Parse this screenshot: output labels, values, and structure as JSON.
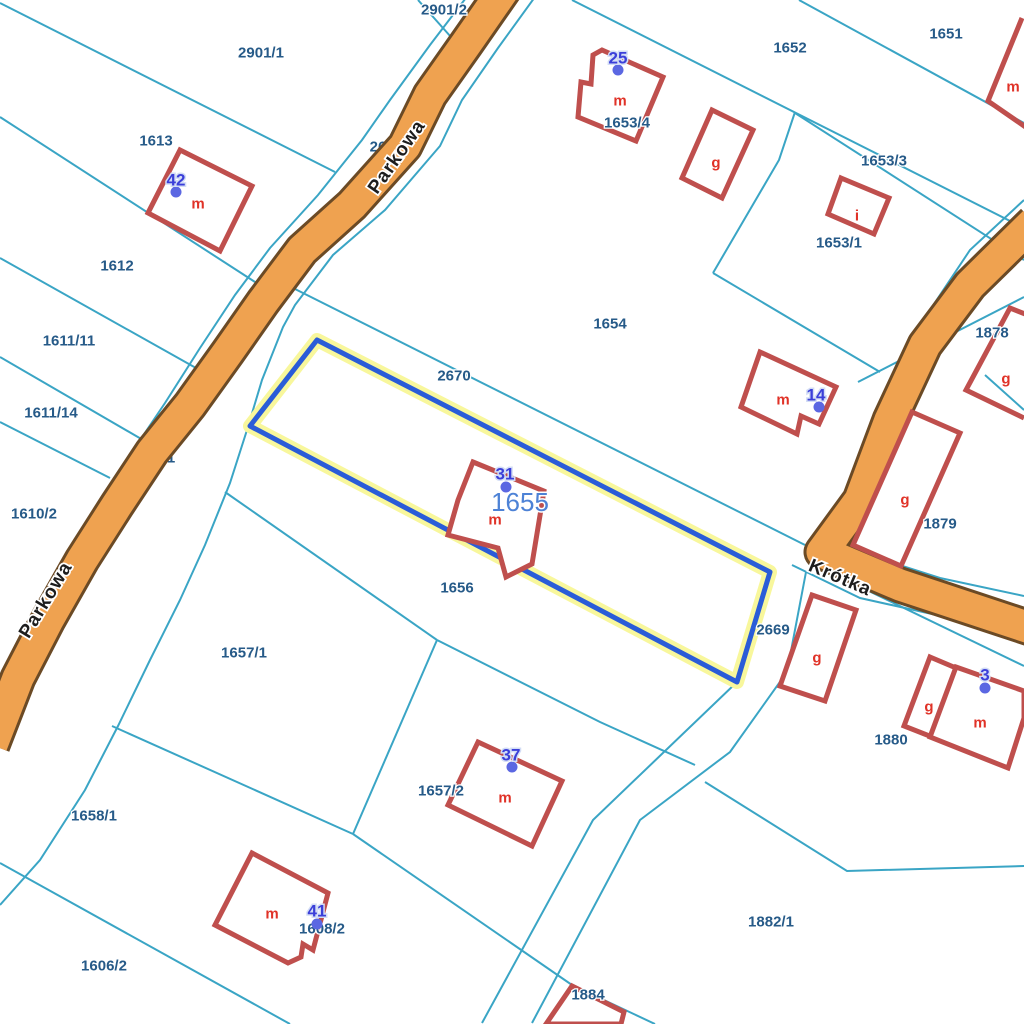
{
  "colors": {
    "background": "#ffffff",
    "parcel_line": "#3aa5c5",
    "building": "#bf4f4d",
    "building_letter": "#e03227",
    "road_fill": "#efa250",
    "road_border": "#6b4a25",
    "highlight_blue": "#2a5cd8",
    "highlight_halo": "#f8f79c",
    "parcel_label": "#265a88",
    "selected_label": "#4d82d6",
    "address_label": "#3b3fd9",
    "address_halo": "#d3ddf5",
    "address_dot": "#5b67e2",
    "street_label": "#1d1d1d"
  },
  "streets": [
    {
      "name": "Parkowa",
      "x": 397,
      "y": 157,
      "rotation": -55
    },
    {
      "name": "Parkowa",
      "x": 46,
      "y": 600,
      "rotation": -59
    },
    {
      "name": "Krótka",
      "x": 840,
      "y": 578,
      "rotation": 23
    }
  ],
  "selected_parcel": {
    "number": "1655",
    "x": 520,
    "y": 502
  },
  "parcels": [
    {
      "number": "2901/2",
      "x": 444,
      "y": 10
    },
    {
      "number": "2901/1",
      "x": 261,
      "y": 53
    },
    {
      "number": "1613",
      "x": 156,
      "y": 141
    },
    {
      "number": "1612",
      "x": 117,
      "y": 266
    },
    {
      "number": "1611/11",
      "x": 69,
      "y": 341
    },
    {
      "number": "1611/14",
      "x": 51,
      "y": 413
    },
    {
      "number": "1610/2",
      "x": 34,
      "y": 514
    },
    {
      "number": "1652",
      "x": 790,
      "y": 48
    },
    {
      "number": "1651",
      "x": 946,
      "y": 34
    },
    {
      "number": "1653/4",
      "x": 627,
      "y": 123
    },
    {
      "number": "1653/3",
      "x": 884,
      "y": 161
    },
    {
      "number": "1653/1",
      "x": 839,
      "y": 243
    },
    {
      "number": "1654",
      "x": 610,
      "y": 324
    },
    {
      "number": "1878",
      "x": 992,
      "y": 333
    },
    {
      "number": "1879",
      "x": 940,
      "y": 524
    },
    {
      "number": "2670",
      "x": 454,
      "y": 376
    },
    {
      "number": "1656",
      "x": 457,
      "y": 588
    },
    {
      "number": "2669",
      "x": 773,
      "y": 630
    },
    {
      "number": "1657/1",
      "x": 244,
      "y": 653
    },
    {
      "number": "1657/2",
      "x": 441,
      "y": 791
    },
    {
      "number": "1880",
      "x": 891,
      "y": 740
    },
    {
      "number": "1658/1",
      "x": 94,
      "y": 816
    },
    {
      "number": "1608/2",
      "x": 322,
      "y": 929
    },
    {
      "number": "1606/2",
      "x": 104,
      "y": 966
    },
    {
      "number": "1882/1",
      "x": 771,
      "y": 922
    },
    {
      "number": "1884",
      "x": 588,
      "y": 995
    },
    {
      "number": "26",
      "x": 378,
      "y": 147,
      "partial": true
    },
    {
      "number": "1",
      "x": 171,
      "y": 458,
      "partial": true
    }
  ],
  "addresses": [
    {
      "number": "42",
      "x": 176,
      "y": 180,
      "dot_x": 176,
      "dot_y": 192
    },
    {
      "number": "25",
      "x": 618,
      "y": 58,
      "dot_x": 618,
      "dot_y": 70
    },
    {
      "number": "14",
      "x": 816,
      "y": 395,
      "dot_x": 819,
      "dot_y": 407
    },
    {
      "number": "31",
      "x": 505,
      "y": 474,
      "dot_x": 506,
      "dot_y": 487
    },
    {
      "number": "3",
      "x": 985,
      "y": 675,
      "dot_x": 985,
      "dot_y": 688
    },
    {
      "number": "37",
      "x": 511,
      "y": 755,
      "dot_x": 512,
      "dot_y": 767
    },
    {
      "number": "41",
      "x": 317,
      "y": 911,
      "dot_x": 317,
      "dot_y": 924
    }
  ],
  "building_letters": [
    {
      "letter": "m",
      "x": 198,
      "y": 204
    },
    {
      "letter": "m",
      "x": 620,
      "y": 101
    },
    {
      "letter": "g",
      "x": 716,
      "y": 163
    },
    {
      "letter": "i",
      "x": 857,
      "y": 216
    },
    {
      "letter": "m",
      "x": 1013,
      "y": 87
    },
    {
      "letter": "m",
      "x": 783,
      "y": 400
    },
    {
      "letter": "g",
      "x": 1006,
      "y": 379
    },
    {
      "letter": "g",
      "x": 905,
      "y": 500
    },
    {
      "letter": "g",
      "x": 817,
      "y": 658
    },
    {
      "letter": "g",
      "x": 929,
      "y": 707
    },
    {
      "letter": "m",
      "x": 980,
      "y": 723
    },
    {
      "letter": "m",
      "x": 495,
      "y": 520
    },
    {
      "letter": "m",
      "x": 505,
      "y": 798
    },
    {
      "letter": "m",
      "x": 272,
      "y": 914
    }
  ]
}
